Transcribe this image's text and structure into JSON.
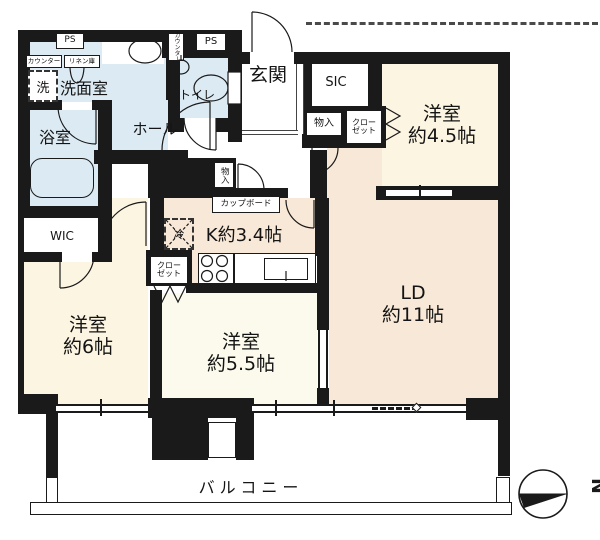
{
  "floorplan": {
    "rooms": {
      "entrance": {
        "label": "玄関"
      },
      "hall": {
        "label": "ホール"
      },
      "shoe_closet": {
        "label": "SIC"
      },
      "washroom": {
        "label": "洗面室"
      },
      "toilet": {
        "label": "トイレ"
      },
      "bathroom": {
        "label": "浴室"
      },
      "walk_in_closet": {
        "label": "WIC"
      },
      "kitchen": {
        "label": "K約3.4帖"
      },
      "living_dining": {
        "name": "LD",
        "size": "約11帖"
      },
      "bedroom_45": {
        "name": "洋室",
        "size": "約4.5帖"
      },
      "bedroom_6": {
        "name": "洋室",
        "size": "約6帖"
      },
      "bedroom_55": {
        "name": "洋室",
        "size": "約5.5帖"
      },
      "balcony": {
        "label": "バルコニー"
      }
    },
    "fixtures": {
      "ps_left": "PS",
      "ps_right": "PS",
      "counter_washroom": "カウンター",
      "counter_toilet": "カウンター",
      "linen_cabinet": "リネン庫",
      "washing_machine": "洗",
      "refrigerator": "冷",
      "cupboard": "カップボード",
      "storage_hall": "物入",
      "storage_entry": "物入",
      "closet_45": {
        "line1": "クロー",
        "line2": "ゼット"
      },
      "closet_55": {
        "line1": "クロー",
        "line2": "ゼット"
      }
    },
    "compass": {
      "north": "N"
    },
    "colors": {
      "wall": "#1a1a1a",
      "tatami_room": "#FBF5E1",
      "ld_kitchen": "#F8E8D7",
      "bedroom55": "#FCFAEC",
      "wet_area": "#DCEBF3"
    }
  }
}
